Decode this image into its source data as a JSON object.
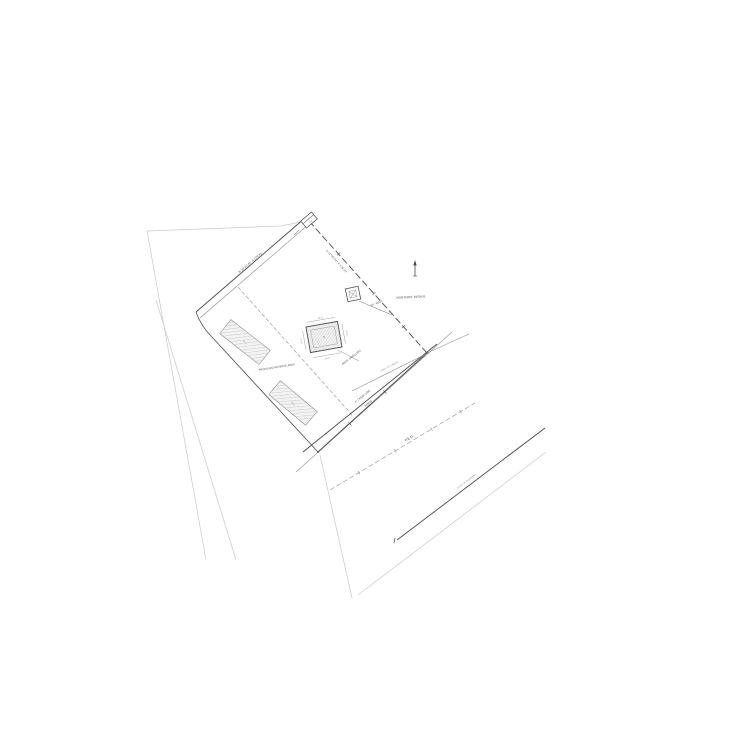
{
  "colors": {
    "background": "#ffffff",
    "line_dark": "#4b4b4b",
    "line_medium": "#8f8f8f",
    "line_faint": "#c9c9c9",
    "hatch_fill": "#f3f3f3",
    "hatch_stroke": "#a3a3a3"
  },
  "labels": {
    "nw_boundary": "N 58°22'40\" E  209.95'",
    "ne_boundary": "S 31°40'20\" E  178.20'",
    "monument": "CM",
    "street": "MONTEREY AVENUE",
    "well": "EX. WELL",
    "dwelling": "PROP. DWELLING",
    "dim_top": "26.0'",
    "dim_right": "24.0'",
    "dim_bottom": "26.0'",
    "dim_left": "24.0'",
    "reserve_area": "PROPOSED RESERVE AREA",
    "test_pit_1": "TP-1",
    "test_pit_2": "TP-2",
    "fence_line1": "4' CHAIN LINK",
    "fence_line2": "FENCE",
    "edge_gravel": "EDGE OF GRAVEL",
    "ped": "P.E.D.",
    "pavement": "EDGE OF PAVEMENT"
  }
}
